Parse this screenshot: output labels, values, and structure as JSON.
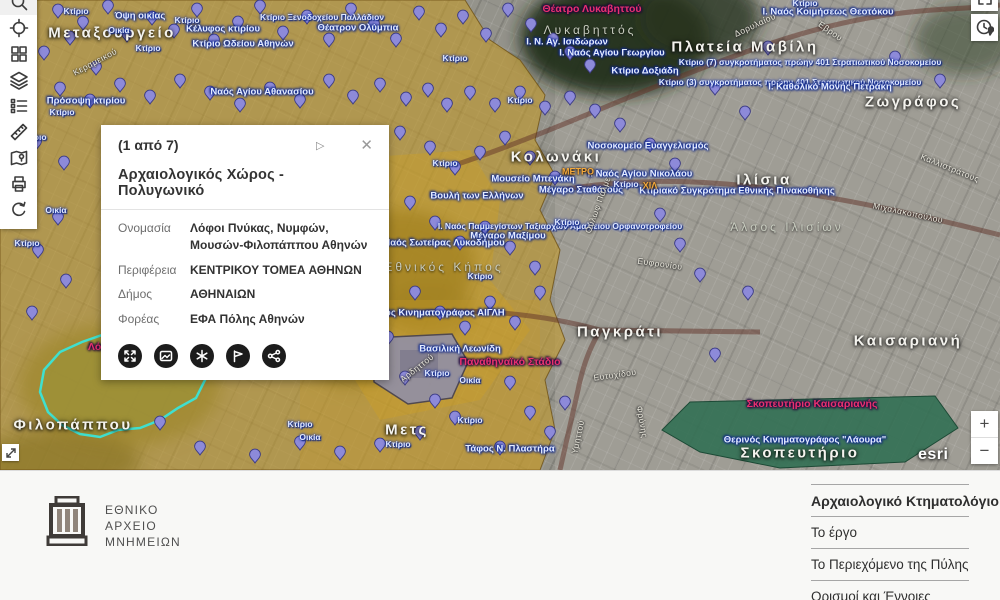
{
  "theme": {
    "selection_color": "#3fe0cf",
    "overlay_yellow": "#c19a2c",
    "pin_color": "#8d8ad9",
    "pin_stroke": "#3b3b85",
    "park_green": "#2f6e52",
    "popup_action_bg": "#1c1c1c"
  },
  "toolbar": {
    "buttons": [
      "search",
      "locate",
      "basemap",
      "layers",
      "legend",
      "measure",
      "map-pin",
      "print",
      "refresh"
    ]
  },
  "map": {
    "attribution": "esri",
    "zoom_in": "+",
    "zoom_out": "−",
    "top_right_buttons": [
      "collapse",
      "locate-clock"
    ],
    "corner_button": "extent-arrows",
    "labels": [
      {
        "s": "Μεταξουργείο",
        "x": 112,
        "y": 33,
        "t": "big"
      },
      {
        "s": "Κολωνάκι",
        "x": 556,
        "y": 157,
        "t": "big"
      },
      {
        "s": "Πλατεία Μαβίλη",
        "x": 745,
        "y": 47,
        "t": "big"
      },
      {
        "s": "Ζωγράφος",
        "x": 913,
        "y": 102,
        "t": "big"
      },
      {
        "s": "Ιλίσια",
        "x": 764,
        "y": 180,
        "t": "big"
      },
      {
        "s": "Παγκράτι",
        "x": 620,
        "y": 332,
        "t": "big"
      },
      {
        "s": "Καισαριανή",
        "x": 908,
        "y": 341,
        "t": "big"
      },
      {
        "s": "Μετς",
        "x": 407,
        "y": 430,
        "t": "big"
      },
      {
        "s": "Φιλοπάππου",
        "x": 73,
        "y": 425,
        "t": "big"
      },
      {
        "s": "Σκοπευτήριο",
        "x": 800,
        "y": 453,
        "t": "big"
      },
      {
        "s": "Λυκαβηττός",
        "x": 590,
        "y": 30,
        "t": "area"
      },
      {
        "s": "Εθνικός Κήπος",
        "x": 444,
        "y": 267,
        "t": "area"
      },
      {
        "s": "Άλσος Ιλισίων",
        "x": 787,
        "y": 227,
        "t": "area"
      },
      {
        "s": "Θέατρο Λυκαβηττού",
        "x": 592,
        "y": 9,
        "t": "red"
      },
      {
        "s": "Παναθηναϊκό Στάδιο",
        "x": 510,
        "y": 362,
        "t": "red"
      },
      {
        "s": "Λόφοι Πνύκας",
        "x": 123,
        "y": 347,
        "t": "red"
      },
      {
        "s": "Σκοπευτήριο Καισαριανής",
        "x": 812,
        "y": 404,
        "t": "red"
      },
      {
        "s": "Ι. Ν. Αγ. Ισιδώρων",
        "x": 567,
        "y": 42,
        "t": "blue"
      },
      {
        "s": "Ι. Ναός Αγίου Γεωργίου",
        "x": 612,
        "y": 53,
        "t": "blue"
      },
      {
        "s": "Ι. Ναός Κοιμήσεως Θεοτόκου",
        "x": 828,
        "y": 12,
        "t": "blue"
      },
      {
        "s": "Κτίριο (7) συγκροτήματος πρώην 401 Στρατιωτικού Νοσοκομείου",
        "x": 810,
        "y": 62,
        "t": "blues"
      },
      {
        "s": "Κτίριο (3) συγκροτήματος πρώην 401 Στρατιωτικού Νοσοκομείου",
        "x": 790,
        "y": 82,
        "t": "blues"
      },
      {
        "s": "Νοσοκομείο Ευαγγελισμός",
        "x": 648,
        "y": 146,
        "t": "blue"
      },
      {
        "s": "Κτιριακό Συγκρότημα Εθνικής Πινακοθήκης",
        "x": 737,
        "y": 191,
        "t": "blue"
      },
      {
        "s": "Ι. Ναός Αγίου Νικολάου",
        "x": 640,
        "y": 174,
        "t": "blue"
      },
      {
        "s": "Ι. Καθολικό Μονής Πετράκη",
        "x": 830,
        "y": 87,
        "t": "blue"
      },
      {
        "s": "Κτίριο Δοξιάδη",
        "x": 645,
        "y": 71,
        "t": "blue"
      },
      {
        "s": "Μουσείο Μπενάκη",
        "x": 533,
        "y": 179,
        "t": "blue"
      },
      {
        "s": "Μέγαρο Σταθάτους",
        "x": 581,
        "y": 190,
        "t": "blue"
      },
      {
        "s": "Βουλή των Ελλήνων",
        "x": 477,
        "y": 196,
        "t": "blue"
      },
      {
        "s": "Ι. Ναός Παμμεγίστων Ταξιαρχών Αμαλίειου Ορφανοτροφείου",
        "x": 560,
        "y": 226,
        "t": "blues"
      },
      {
        "s": "Μέγαρο Μαξίμου",
        "x": 508,
        "y": 236,
        "t": "blue"
      },
      {
        "s": "Ναός Σωτείρας Λυκοδήμου",
        "x": 444,
        "y": 243,
        "t": "blue"
      },
      {
        "s": "Θερινός Κινηματογράφος ΑΙΓΛΗ",
        "x": 432,
        "y": 313,
        "t": "blue"
      },
      {
        "s": "Βασιλική Λεωνίδη",
        "x": 460,
        "y": 349,
        "t": "blue"
      },
      {
        "s": "Μνημείο Φιλοπάππου",
        "x": 205,
        "y": 371,
        "t": "blue"
      },
      {
        "s": "Θερινός Κινηματογράφος \"Λάουρα\"",
        "x": 805,
        "y": 440,
        "t": "blue"
      },
      {
        "s": "Τάφος Ν. Πλαστήρα",
        "x": 510,
        "y": 449,
        "t": "blue"
      },
      {
        "s": "Κτίριο Ωδείου Αθηνών",
        "x": 243,
        "y": 44,
        "t": "blue"
      },
      {
        "s": "Ναός Αγίου Αθανασίου",
        "x": 262,
        "y": 92,
        "t": "blue"
      },
      {
        "s": "Όψη οικίας",
        "x": 140,
        "y": 16,
        "t": "blue"
      },
      {
        "s": "Κέλυφος κτιρίου",
        "x": 223,
        "y": 29,
        "t": "blue"
      },
      {
        "s": "Πρόσοψη κτιρίου",
        "x": 86,
        "y": 101,
        "t": "blue"
      },
      {
        "s": "Κτίριο Ξενοδοχείου Παλλάδιον",
        "x": 322,
        "y": 17,
        "t": "blues"
      },
      {
        "s": "Θέατρον Ολύμπια",
        "x": 358,
        "y": 28,
        "t": "blue"
      },
      {
        "s": "Κτίριο",
        "x": 76,
        "y": 11,
        "t": "blues"
      },
      {
        "s": "Κτίριο",
        "x": 187,
        "y": 20,
        "t": "blues"
      },
      {
        "s": "Κτίριο",
        "x": 148,
        "y": 48,
        "t": "blues"
      },
      {
        "s": "Κτίριο",
        "x": 62,
        "y": 112,
        "t": "blues"
      },
      {
        "s": "Κτίριο",
        "x": 34,
        "y": 137,
        "t": "blues"
      },
      {
        "s": "Κτίριο",
        "x": 27,
        "y": 243,
        "t": "blues"
      },
      {
        "s": "Κτίριο",
        "x": 455,
        "y": 58,
        "t": "blues"
      },
      {
        "s": "Κτίριο",
        "x": 520,
        "y": 100,
        "t": "blues"
      },
      {
        "s": "Κτίριο",
        "x": 445,
        "y": 163,
        "t": "blues"
      },
      {
        "s": "Κτίριο",
        "x": 567,
        "y": 222,
        "t": "blues"
      },
      {
        "s": "Κτίριο",
        "x": 480,
        "y": 276,
        "t": "blues"
      },
      {
        "s": "Κτίριο",
        "x": 437,
        "y": 373,
        "t": "blues"
      },
      {
        "s": "Κτίριο",
        "x": 470,
        "y": 420,
        "t": "blues"
      },
      {
        "s": "Κτίριο",
        "x": 300,
        "y": 424,
        "t": "blues"
      },
      {
        "s": "Κτίριο",
        "x": 398,
        "y": 444,
        "t": "blues"
      },
      {
        "s": "Κτίριο",
        "x": 805,
        "y": 3,
        "t": "blues"
      },
      {
        "s": "Κτίριο",
        "x": 626,
        "y": 184,
        "t": "blues"
      },
      {
        "s": "Οικία",
        "x": 119,
        "y": 30,
        "t": "blues"
      },
      {
        "s": "Οικία",
        "x": 470,
        "y": 380,
        "t": "blues"
      },
      {
        "s": "Οικία",
        "x": 56,
        "y": 210,
        "t": "blues"
      },
      {
        "s": "Οικία",
        "x": 310,
        "y": 437,
        "t": "blues"
      },
      {
        "s": "ΜΕΤΡΟ",
        "x": 578,
        "y": 172,
        "t": "orange"
      },
      {
        "s": "ΧΙΛ",
        "x": 650,
        "y": 186,
        "t": "orange"
      },
      {
        "s": "Κεραμεικού",
        "x": 95,
        "y": 62,
        "t": "street",
        "r": -28
      },
      {
        "s": "Αρδηττού",
        "x": 417,
        "y": 368,
        "t": "street",
        "r": -38
      },
      {
        "s": "Ευτυχίδου",
        "x": 615,
        "y": 375,
        "t": "street",
        "r": -8
      },
      {
        "s": "Υμηττού",
        "x": 578,
        "y": 437,
        "t": "street",
        "r": -78
      },
      {
        "s": "Μιχαλακοπούλου",
        "x": 908,
        "y": 213,
        "t": "street",
        "r": 12
      },
      {
        "s": "Ούλωφ Πάλμε",
        "x": 598,
        "y": 205,
        "t": "street",
        "r": -70
      },
      {
        "s": "Καλλιστράτους",
        "x": 950,
        "y": 168,
        "t": "street",
        "r": 22
      },
      {
        "s": "Ευφρονίου",
        "x": 660,
        "y": 264,
        "t": "street",
        "r": 8
      },
      {
        "s": "Φρύνης",
        "x": 642,
        "y": 422,
        "t": "street",
        "r": 80
      },
      {
        "s": "Έβρου",
        "x": 830,
        "y": 31,
        "t": "street",
        "r": 35
      },
      {
        "s": "Δορυλαίου",
        "x": 755,
        "y": 25,
        "t": "street",
        "r": -25
      }
    ],
    "pins": [
      [
        58,
        18
      ],
      [
        83,
        30
      ],
      [
        108,
        14
      ],
      [
        127,
        42
      ],
      [
        152,
        25
      ],
      [
        174,
        38
      ],
      [
        197,
        17
      ],
      [
        214,
        48
      ],
      [
        238,
        30
      ],
      [
        260,
        14
      ],
      [
        283,
        40
      ],
      [
        307,
        24
      ],
      [
        329,
        47
      ],
      [
        351,
        17
      ],
      [
        374,
        32
      ],
      [
        396,
        47
      ],
      [
        419,
        20
      ],
      [
        441,
        37
      ],
      [
        463,
        24
      ],
      [
        486,
        42
      ],
      [
        508,
        17
      ],
      [
        531,
        32
      ],
      [
        553,
        47
      ],
      [
        570,
        60
      ],
      [
        590,
        73
      ],
      [
        44,
        60
      ],
      [
        70,
        45
      ],
      [
        96,
        75
      ],
      [
        60,
        96
      ],
      [
        90,
        108
      ],
      [
        120,
        92
      ],
      [
        150,
        104
      ],
      [
        180,
        88
      ],
      [
        210,
        100
      ],
      [
        240,
        112
      ],
      [
        270,
        96
      ],
      [
        300,
        108
      ],
      [
        329,
        88
      ],
      [
        353,
        104
      ],
      [
        380,
        92
      ],
      [
        406,
        106
      ],
      [
        428,
        97
      ],
      [
        447,
        112
      ],
      [
        470,
        100
      ],
      [
        495,
        112
      ],
      [
        520,
        100
      ],
      [
        545,
        115
      ],
      [
        36,
        150
      ],
      [
        64,
        170
      ],
      [
        30,
        195
      ],
      [
        58,
        225
      ],
      [
        38,
        258
      ],
      [
        66,
        288
      ],
      [
        32,
        320
      ],
      [
        400,
        140
      ],
      [
        430,
        155
      ],
      [
        455,
        175
      ],
      [
        480,
        160
      ],
      [
        505,
        145
      ],
      [
        530,
        165
      ],
      [
        555,
        185
      ],
      [
        410,
        210
      ],
      [
        435,
        230
      ],
      [
        460,
        250
      ],
      [
        485,
        235
      ],
      [
        510,
        255
      ],
      [
        535,
        275
      ],
      [
        415,
        300
      ],
      [
        440,
        320
      ],
      [
        465,
        335
      ],
      [
        490,
        310
      ],
      [
        515,
        330
      ],
      [
        540,
        300
      ],
      [
        570,
        105
      ],
      [
        595,
        118
      ],
      [
        620,
        132
      ],
      [
        650,
        152
      ],
      [
        675,
        172
      ],
      [
        660,
        222
      ],
      [
        680,
        252
      ],
      [
        700,
        282
      ],
      [
        160,
        430
      ],
      [
        200,
        455
      ],
      [
        255,
        463
      ],
      [
        300,
        450
      ],
      [
        340,
        460
      ],
      [
        380,
        452
      ],
      [
        420,
        440
      ],
      [
        455,
        425
      ],
      [
        435,
        408
      ],
      [
        405,
        385
      ],
      [
        510,
        390
      ],
      [
        530,
        420
      ],
      [
        500,
        455
      ],
      [
        550,
        440
      ],
      [
        565,
        410
      ],
      [
        388,
        345
      ],
      [
        372,
        360
      ],
      [
        715,
        95
      ],
      [
        745,
        120
      ],
      [
        748,
        300
      ],
      [
        715,
        362
      ],
      [
        895,
        65
      ],
      [
        940,
        88
      ],
      [
        768,
        55
      ]
    ]
  },
  "popup": {
    "pager": "(1 από 7)",
    "next_icon": "▷",
    "close_icon": "✕",
    "title": "Αρχαιολογικός Χώρος - Πολυγωνικό",
    "fields": [
      {
        "label": "Ονομασία",
        "value": "Λόφοι Πνύκας, Νυμφών, Μουσών-Φιλοπάππου Αθηνών"
      },
      {
        "label": "Περιφέρεια",
        "value": "ΚΕΝΤΡΙΚΟΥ ΤΟΜΕΑ ΑΘΗΝΩΝ"
      },
      {
        "label": "Δήμος",
        "value": "ΑΘΗΝΑΙΩΝ"
      },
      {
        "label": "Φορέας",
        "value": "ΕΦΑ Πόλης Αθηνών"
      }
    ],
    "actions": [
      "zoom-to",
      "media",
      "asterisk",
      "flag",
      "share"
    ]
  },
  "footer": {
    "logo_lines": [
      "ΕΘΝΙΚΟ",
      "ΑΡΧΕΙΟ",
      "ΜΝΗΜΕΙΩΝ"
    ],
    "links": [
      {
        "label": "Αρχαιολογικό Κτηματολόγιο"
      },
      {
        "label": "Το έργο"
      },
      {
        "label": "Το Περιεχόμενο της Πύλης"
      },
      {
        "label": "Ορισμοί και Έννοιες"
      }
    ]
  }
}
